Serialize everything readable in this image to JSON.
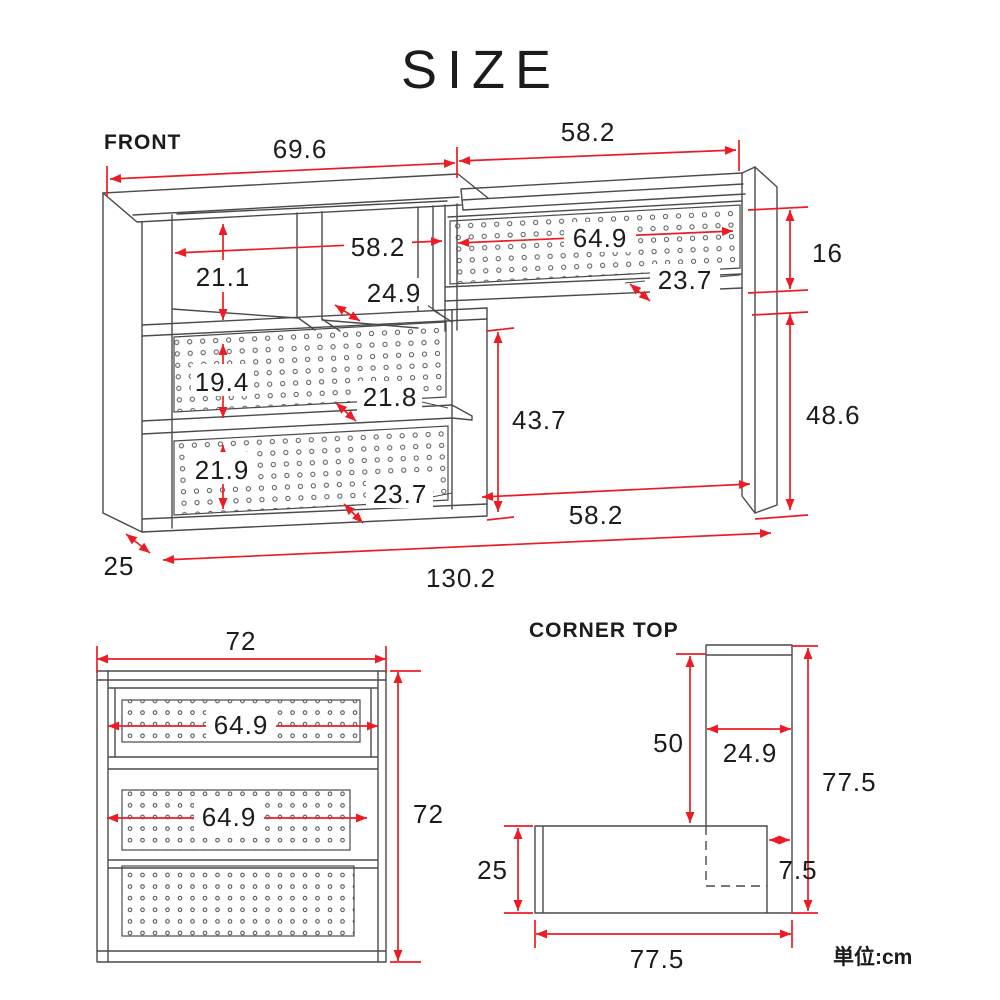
{
  "title": "SIZE",
  "unit_label": "単位:cm",
  "colors": {
    "dimension_red": "#ed1c24",
    "line_gray": "#4a4a4a",
    "text_black": "#1c1c1c"
  },
  "front": {
    "label": "FRONT",
    "dims": {
      "top_left_width": "69.6",
      "top_right_width": "58.2",
      "inner_width": "58.2",
      "cubby_height": "21.1",
      "mid_depth": "24.9",
      "right_peg_width": "64.9",
      "right_shelf_depth": "23.7",
      "right_gap_height": "16",
      "peg1_height": "19.4",
      "mid_shelf_depth": "21.8",
      "knee_height": "43.7",
      "leg_height": "48.6",
      "peg2_height": "21.9",
      "lower_depth": "23.7",
      "knee_width": "58.2",
      "side_depth": "25",
      "total_width": "130.2"
    }
  },
  "side": {
    "dims": {
      "width": "72",
      "peg_top_width": "64.9",
      "peg_mid_width": "64.9",
      "height": "72"
    }
  },
  "corner": {
    "label": "CORNER TOP",
    "dims": {
      "clearance": "50",
      "panel_width": "24.9",
      "right_depth": "77.5",
      "left_depth": "25",
      "overlap": "7.5",
      "bottom_width": "77.5"
    }
  }
}
